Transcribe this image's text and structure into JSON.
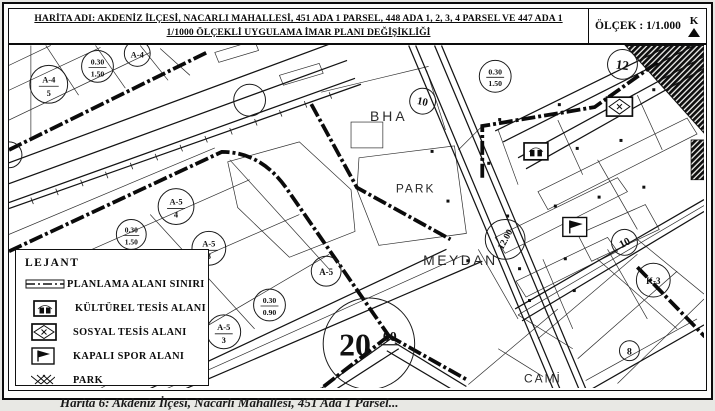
{
  "page": {
    "caption": "Harita 6: Akdeniz İlçesi, Nacarlı Mahallesi, 451 Ada 1 Parsel...",
    "colors": {
      "ink": "#0c0c0c",
      "paper": "#ffffff",
      "page_tint": "#fdfdfb"
    }
  },
  "header": {
    "title_line1": "HARİTA ADI: AKDENİZ İLÇESİ, NACARLI MAHALLESİ, 451 ADA 1 PARSEL, 448 ADA 1, 2, 3, 4 PARSEL VE 447 ADA 1",
    "title_line2": "1/1000 ÖLÇEKLİ UYGULAMA İMAR PLANI DEĞİŞİKLİĞİ",
    "scale_label": "ÖLÇEK : 1/1.000",
    "north_letter": "K",
    "north_icon": "north-arrow-up-triangle"
  },
  "legend": {
    "title": "LEJANT",
    "items": [
      {
        "symbol": "plan-boundary-line",
        "label": "PLANLAMA ALANI SINIRI"
      },
      {
        "symbol": "cultural-facility-icon",
        "label": "KÜLTÜREL TESİS ALANI"
      },
      {
        "symbol": "social-facility-icon",
        "label": "SOSYAL TESİS ALANI"
      },
      {
        "symbol": "indoor-sports-icon",
        "label": "KAPALI SPOR ALANI"
      },
      {
        "symbol": "park-stipple-texture",
        "label": "PARK"
      }
    ]
  },
  "map": {
    "area_labels": [
      {
        "text": "BHA"
      },
      {
        "text": "PARK"
      },
      {
        "text": "MEYDAN"
      },
      {
        "text": "CAMİ"
      }
    ],
    "zoning_circles": [
      {
        "top": "A-4",
        "bottom": "5"
      },
      {
        "top": "0.30",
        "bottom": "1.50"
      },
      {
        "top": "A-4",
        "bottom": ""
      },
      {
        "top": "A-5",
        "bottom": "4"
      },
      {
        "top": "0.30",
        "bottom": "1.50"
      },
      {
        "top": "A-5",
        "bottom": "3"
      },
      {
        "top": "A-5",
        "bottom": "3"
      },
      {
        "top": "0.30",
        "bottom": "0.90"
      },
      {
        "top": "A-5",
        "bottom": ""
      },
      {
        "top": "0.30",
        "bottom": "1.50"
      },
      {
        "top": "K-3",
        "bottom": ""
      }
    ],
    "road_width_circles": [
      {
        "label": "10"
      },
      {
        "label": "12"
      },
      {
        "label": "12.00"
      },
      {
        "label": "10"
      },
      {
        "label": "8"
      }
    ],
    "big_road_width_circle": {
      "main": "20",
      "sup": "00"
    },
    "facility_icons": [
      "cultural-facility-icon",
      "social-facility-icon",
      "indoor-sports-icon"
    ]
  }
}
